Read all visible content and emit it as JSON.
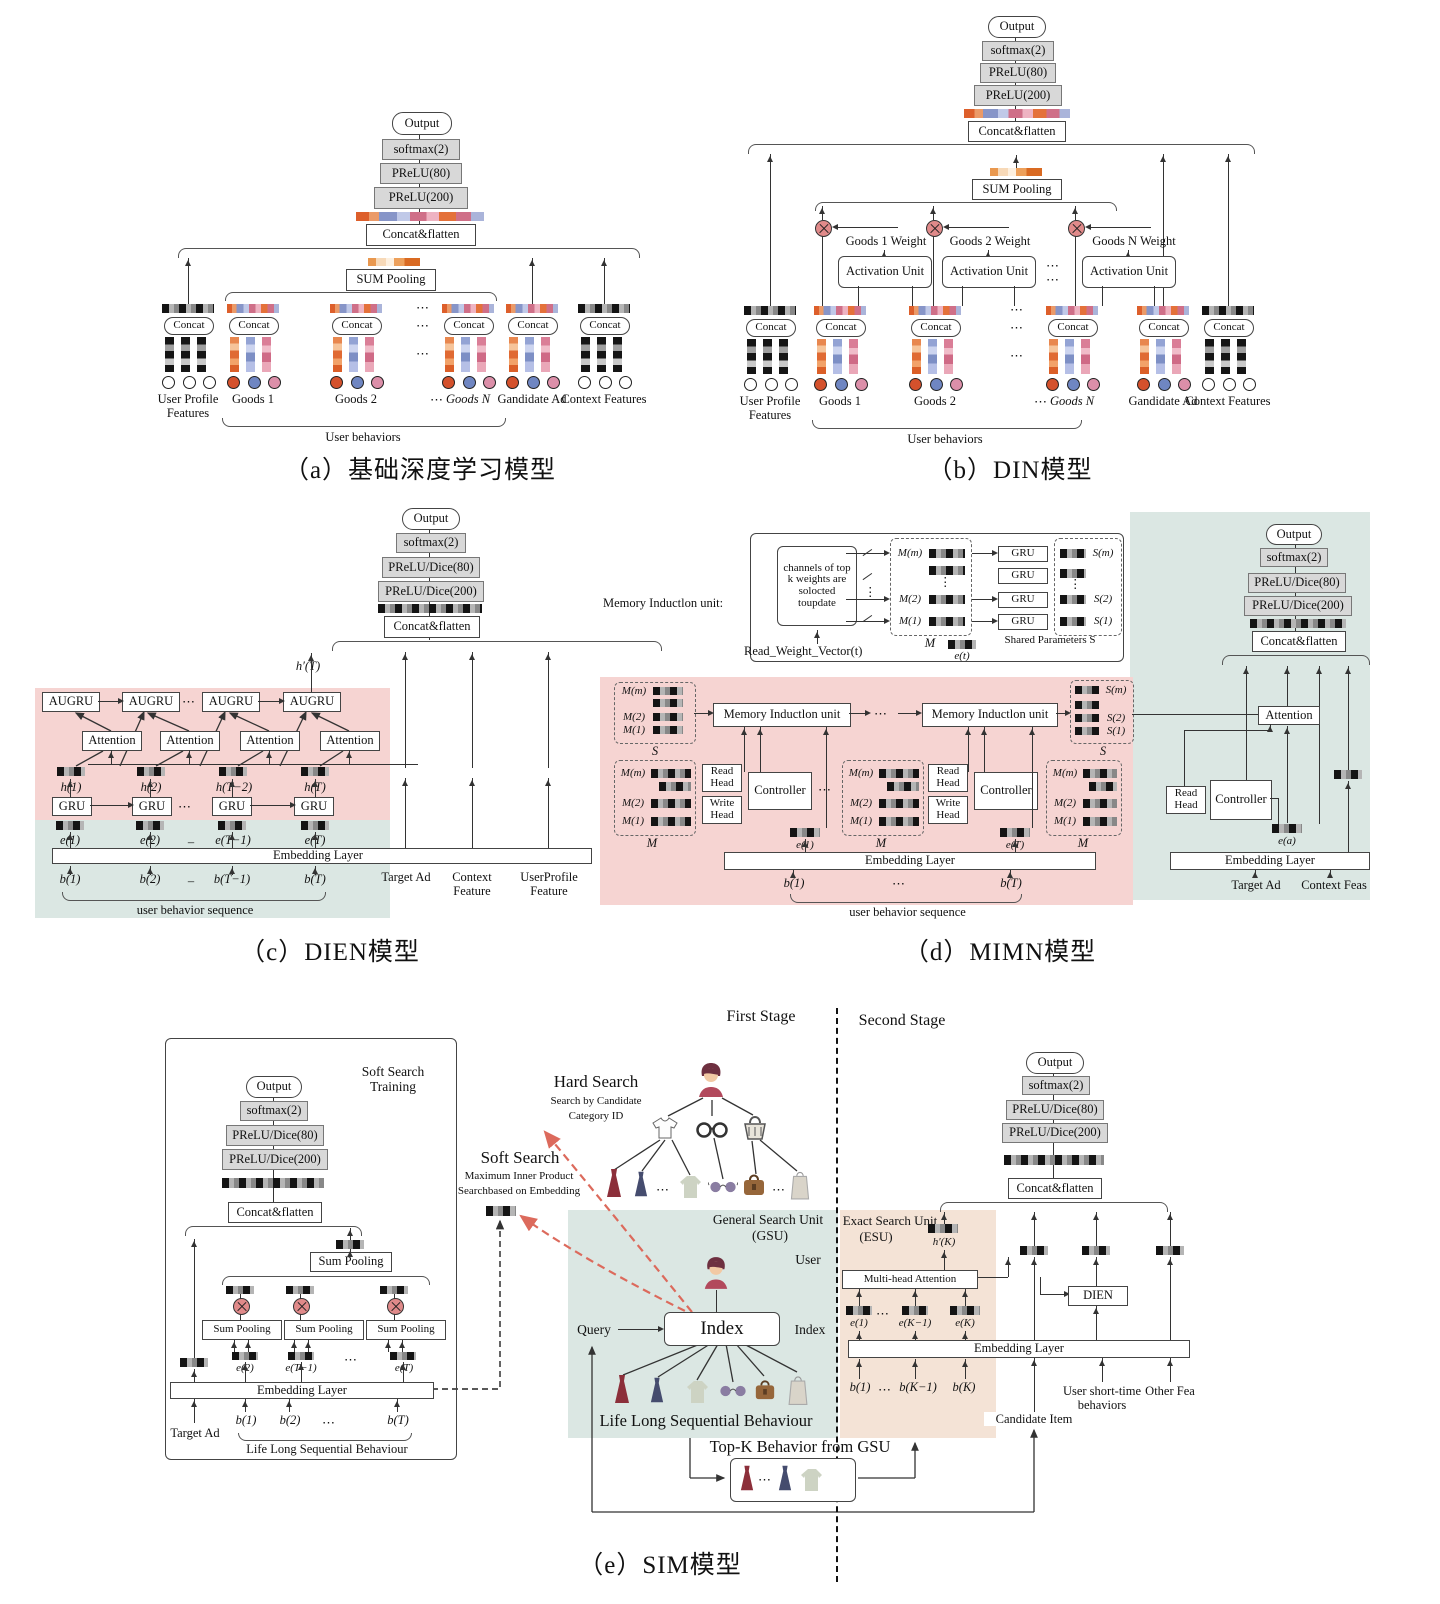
{
  "panel_a": {
    "caption": "（a）基础深度学习模型",
    "output": "Output",
    "softmax": "softmax(2)",
    "prelu80": "PReLU(80)",
    "prelu200": "PReLU(200)",
    "concat_flatten": "Concat&flatten",
    "sum_pooling": "SUM Pooling",
    "concat": "Concat",
    "groups": [
      "User Profile Features",
      "Goods 1",
      "Goods 2",
      "Goods N",
      "Gandidate Ad",
      "Context Features"
    ],
    "user_behaviors": "User behaviors",
    "dots": "⋯"
  },
  "panel_b": {
    "caption": "（b）DIN模型",
    "output": "Output",
    "softmax": "softmax(2)",
    "prelu80": "PReLU(80)",
    "prelu200": "PReLU(200)",
    "concat_flatten": "Concat&flatten",
    "sum_pooling": "SUM Pooling",
    "concat": "Concat",
    "weights": [
      "Goods 1 Weight",
      "Goods 2 Weight",
      "Goods N Weight"
    ],
    "activation": "Activation Unit",
    "groups": [
      "User Profile Features",
      "Goods 1",
      "Goods 2",
      "Goods N",
      "Gandidate Ad",
      "Context Features"
    ],
    "user_behaviors": "User behaviors",
    "dots": "⋯"
  },
  "panel_c": {
    "caption": "（c）DIEN模型",
    "output": "Output",
    "softmax": "softmax(2)",
    "prelu80": "PReLU/Dice(80)",
    "prelu200": "PReLU/Dice(200)",
    "concat_flatten": "Concat&flatten",
    "h_prime": "h′(T)",
    "augru": "AUGRU",
    "attention": "Attention",
    "gru": "GRU",
    "h": [
      "h(1)",
      "h(2)",
      "h(T−2)",
      "h(T)"
    ],
    "e": [
      "e(1)",
      "e(2)",
      "e(T−1)",
      "e(T)"
    ],
    "b": [
      "b(1)",
      "b(2)",
      "b(T−1)",
      "b(T)"
    ],
    "dash": "–",
    "dots": "⋯",
    "embedding": "Embedding Layer",
    "sequence": "user behavior sequence",
    "inputs": [
      "Target Ad",
      "Context Feature",
      "UserProfile Feature"
    ]
  },
  "panel_d": {
    "caption": "（d）MIMN模型",
    "miu_label": "Memory Inductlon unit:",
    "miu_box": "Memory Inductlon unit",
    "channels": "channels of top k weights are solocted toupdate",
    "read_weight": "Read_Weight_Vector(t)",
    "m_rows": [
      "M(m)",
      "M(2)",
      "M(1)"
    ],
    "s_rows": [
      "S(m)",
      "S(2)",
      "S(1)"
    ],
    "m_label": "M",
    "s_label": "S",
    "shared": "Shared Parameters S",
    "et": "e(t)",
    "ea": "e(a)",
    "gru": "GRU",
    "read_head": "Read Head",
    "write_head": "Write Head",
    "controller": "Controller",
    "e1": "e(1)",
    "eT": "e(T)",
    "embedding": "Embedding Layer",
    "b1": "b(1)",
    "bT": "b(T)",
    "dots": "⋯",
    "vdots": "⋮",
    "sequence": "user behavior sequence",
    "output": "Output",
    "softmax": "softmax(2)",
    "prelu80": "PReLU/Dice(80)",
    "prelu200": "PReLU/Dice(200)",
    "concat_flatten": "Concat&flatten",
    "attention": "Attention",
    "target_ad": "Target Ad",
    "context_feas": "Context Feas"
  },
  "panel_e": {
    "caption": "（e）SIM模型",
    "first_stage": "First Stage",
    "second_stage": "Second Stage",
    "soft_search_training": "Soft Search Training",
    "output": "Output",
    "softmax": "softmax(2)",
    "prelu80": "PReLU/Dice(80)",
    "prelu200": "PReLU/Dice(200)",
    "concat_flatten": "Concat&flatten",
    "sum_pooling": "Sum Pooling",
    "e_labels": [
      "e(2)",
      "e(T−1)",
      "e(T)"
    ],
    "embedding": "Embedding Layer",
    "target_ad": "Target Ad",
    "b_labels": [
      "b(1)",
      "b(2)",
      "b(T)"
    ],
    "dots": "⋯",
    "llsb": "Life Long Sequential Behaviour",
    "hard_search": "Hard Search",
    "hard_sub1": "Search by Candidate",
    "hard_sub2": "Category ID",
    "soft_search": "Soft Search",
    "soft_sub1": "Maximum Inner Product",
    "soft_sub2": "Searchbased on Embedding",
    "gsu": "General Search Unit",
    "gsu2": "(GSU)",
    "user": "User",
    "query": "Query",
    "index": "Index",
    "index_label": "Index",
    "topk": "Top-K Behavior from GSU",
    "esu": "Exact Search Unit",
    "esu2": "(ESU)",
    "hK": "h′(K)",
    "mha": "Multi-head Attention",
    "e2_labels": [
      "e(1)",
      "e(K−1)",
      "e(K)"
    ],
    "b2_labels": [
      "b(1)",
      "b(K−1)",
      "b(K)"
    ],
    "embedding2": "Embedding Layer",
    "dien": "DIEN",
    "candidate_item": "Candidate Item",
    "ust": "User short-time behaviors",
    "other_fea": "Other Fea"
  }
}
